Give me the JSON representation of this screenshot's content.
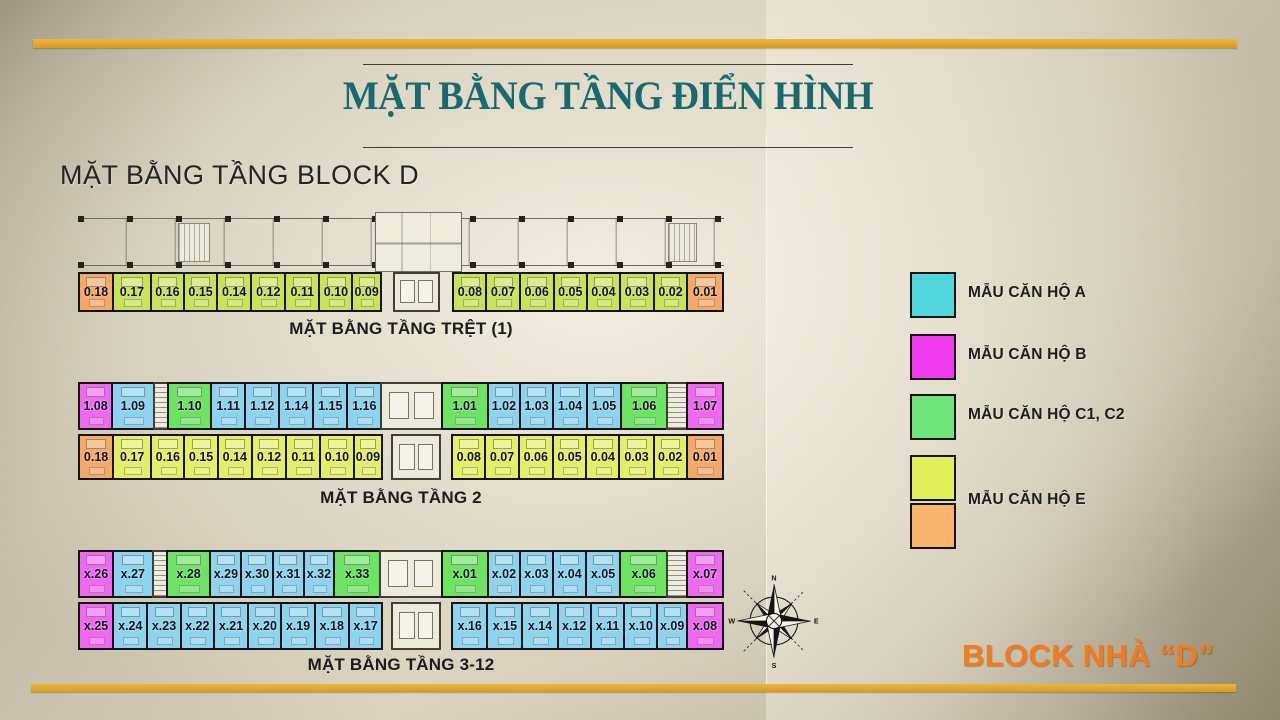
{
  "slide": {
    "title": "MẶT BẰNG TẦNG ĐIỂN HÌNH",
    "subtitle": "MẶT BẰNG TẦNG BLOCK D",
    "block_label": "BLOCK NHÀ “D”"
  },
  "colors": {
    "accent_gold": "#e2a52f",
    "title_teal": "#19696f",
    "block_orange": "#f5791d",
    "a": "#8dd3f0",
    "b": "#f067f0",
    "c": "#6ee263",
    "ey": "#e4ee66",
    "eg": "#c9e257",
    "eo": "#f5a967",
    "la": "#4fd5db",
    "lb": "#ee3cee",
    "lc": "#70e57c",
    "ley": "#e1f05a",
    "leo": "#f7b46b"
  },
  "legend": {
    "items": [
      {
        "label": "MẪU CĂN HỘ A"
      },
      {
        "label": "MẪU CĂN HỘ B"
      },
      {
        "label": "MẪU CĂN HỘ C1, C2"
      },
      {
        "label": "MẪU CĂN HỘ E"
      }
    ]
  },
  "compass": {
    "north": "N",
    "east": "E",
    "south": "S",
    "west": "W"
  },
  "strips": [
    {
      "label": "MẶT BẰNG TẦNG TRỆT (1)",
      "rows": [
        {
          "cells": [
            {
              "n": "0.18",
              "c": "eo",
              "w": 34
            },
            {
              "n": "0.17",
              "c": "eg",
              "w": 38
            },
            {
              "n": "0.16",
              "c": "eg",
              "w": 33
            },
            {
              "n": "0.15",
              "c": "eg",
              "w": 33
            },
            {
              "n": "0.14",
              "c": "eg",
              "w": 34
            },
            {
              "n": "0.12",
              "c": "eg",
              "w": 34
            },
            {
              "n": "0.11",
              "c": "eg",
              "w": 34
            },
            {
              "n": "0.10",
              "c": "eg",
              "w": 33
            },
            {
              "n": "0.09",
              "c": "eg",
              "w": 28
            },
            {
              "t": "space",
              "w": 16
            },
            {
              "t": "core",
              "w": 46
            },
            {
              "t": "space",
              "w": 17
            },
            {
              "n": "0.08",
              "c": "eg",
              "w": 33
            },
            {
              "n": "0.07",
              "c": "eg",
              "w": 33
            },
            {
              "n": "0.06",
              "c": "eg",
              "w": 34
            },
            {
              "n": "0.05",
              "c": "eg",
              "w": 33
            },
            {
              "n": "0.04",
              "c": "eg",
              "w": 33
            },
            {
              "n": "0.03",
              "c": "eg",
              "w": 34
            },
            {
              "n": "0.02",
              "c": "eg",
              "w": 33
            },
            {
              "n": "0.01",
              "c": "eo",
              "w": 36
            }
          ]
        }
      ]
    },
    {
      "label": "MẶT BẰNG TẦNG 2",
      "rows": [
        {
          "cells": [
            {
              "n": "1.08",
              "c": "b",
              "w": 33
            },
            {
              "n": "1.09",
              "c": "a",
              "w": 42
            },
            {
              "t": "stair",
              "w": 13
            },
            {
              "n": "1.10",
              "c": "c",
              "w": 44
            },
            {
              "n": "1.11",
              "c": "a",
              "w": 34
            },
            {
              "n": "1.12",
              "c": "a",
              "w": 34
            },
            {
              "n": "1.14",
              "c": "a",
              "w": 34
            },
            {
              "n": "1.15",
              "c": "a",
              "w": 34
            },
            {
              "n": "1.16",
              "c": "a",
              "w": 34
            },
            {
              "t": "core",
              "w": 62
            },
            {
              "n": "1.01",
              "c": "c",
              "w": 47
            },
            {
              "n": "1.02",
              "c": "a",
              "w": 32
            },
            {
              "n": "1.03",
              "c": "a",
              "w": 33
            },
            {
              "n": "1.04",
              "c": "a",
              "w": 34
            },
            {
              "n": "1.05",
              "c": "a",
              "w": 34
            },
            {
              "n": "1.06",
              "c": "c",
              "w": 47
            },
            {
              "t": "stair",
              "w": 19
            },
            {
              "n": "1.07",
              "c": "b",
              "w": 36
            }
          ]
        },
        {
          "cells": [
            {
              "n": "0.18",
              "c": "eo",
              "w": 34
            },
            {
              "n": "0.17",
              "c": "ey",
              "w": 38
            },
            {
              "n": "0.16",
              "c": "ey",
              "w": 33
            },
            {
              "n": "0.15",
              "c": "ey",
              "w": 33
            },
            {
              "n": "0.14",
              "c": "ey",
              "w": 34
            },
            {
              "n": "0.12",
              "c": "ey",
              "w": 34
            },
            {
              "n": "0.11",
              "c": "ey",
              "w": 34
            },
            {
              "n": "0.10",
              "c": "ey",
              "w": 33
            },
            {
              "n": "0.09",
              "c": "ey",
              "w": 28
            },
            {
              "t": "space",
              "w": 13
            },
            {
              "t": "core",
              "w": 48
            },
            {
              "t": "space",
              "w": 15
            },
            {
              "n": "0.08",
              "c": "ey",
              "w": 33
            },
            {
              "n": "0.07",
              "c": "ey",
              "w": 33
            },
            {
              "n": "0.06",
              "c": "ey",
              "w": 34
            },
            {
              "n": "0.05",
              "c": "ey",
              "w": 33
            },
            {
              "n": "0.04",
              "c": "ey",
              "w": 33
            },
            {
              "n": "0.03",
              "c": "ey",
              "w": 34
            },
            {
              "n": "0.02",
              "c": "ey",
              "w": 33
            },
            {
              "n": "0.01",
              "c": "eo",
              "w": 36
            }
          ]
        }
      ]
    },
    {
      "label": "MẶT BẰNG TẦNG 3-12",
      "rows": [
        {
          "cells": [
            {
              "n": "x.26",
              "c": "b",
              "w": 34
            },
            {
              "n": "x.27",
              "c": "a",
              "w": 40
            },
            {
              "t": "stair",
              "w": 13
            },
            {
              "n": "x.28",
              "c": "c",
              "w": 44
            },
            {
              "n": "x.29",
              "c": "a",
              "w": 31
            },
            {
              "n": "x.30",
              "c": "a",
              "w": 31
            },
            {
              "n": "x.31",
              "c": "a",
              "w": 31
            },
            {
              "n": "x.32",
              "c": "a",
              "w": 30
            },
            {
              "n": "x.33",
              "c": "c",
              "w": 47
            },
            {
              "t": "core",
              "w": 63
            },
            {
              "n": "x.01",
              "c": "c",
              "w": 47
            },
            {
              "n": "x.02",
              "c": "a",
              "w": 32
            },
            {
              "n": "x.03",
              "c": "a",
              "w": 33
            },
            {
              "n": "x.04",
              "c": "a",
              "w": 33
            },
            {
              "n": "x.05",
              "c": "a",
              "w": 34
            },
            {
              "n": "x.06",
              "c": "c",
              "w": 48
            },
            {
              "t": "stair",
              "w": 19
            },
            {
              "n": "x.07",
              "c": "b",
              "w": 36
            }
          ]
        },
        {
          "cells": [
            {
              "n": "x.25",
              "c": "b",
              "w": 34
            },
            {
              "n": "x.24",
              "c": "a",
              "w": 34
            },
            {
              "n": "x.23",
              "c": "a",
              "w": 33
            },
            {
              "n": "x.22",
              "c": "a",
              "w": 33
            },
            {
              "n": "x.21",
              "c": "a",
              "w": 34
            },
            {
              "n": "x.20",
              "c": "a",
              "w": 33
            },
            {
              "n": "x.19",
              "c": "a",
              "w": 33
            },
            {
              "n": "x.18",
              "c": "a",
              "w": 34
            },
            {
              "n": "x.17",
              "c": "a",
              "w": 33
            },
            {
              "t": "space",
              "w": 13
            },
            {
              "t": "core",
              "w": 48
            },
            {
              "t": "space",
              "w": 15
            },
            {
              "n": "x.16",
              "c": "a",
              "w": 35
            },
            {
              "n": "x.15",
              "c": "a",
              "w": 35
            },
            {
              "n": "x.14",
              "c": "a",
              "w": 35
            },
            {
              "n": "x.12",
              "c": "a",
              "w": 33
            },
            {
              "n": "x.11",
              "c": "a",
              "w": 33
            },
            {
              "n": "x.10",
              "c": "a",
              "w": 33
            },
            {
              "n": "x.09",
              "c": "a",
              "w": 29
            },
            {
              "n": "x.08",
              "c": "b",
              "w": 36
            }
          ]
        }
      ]
    }
  ]
}
